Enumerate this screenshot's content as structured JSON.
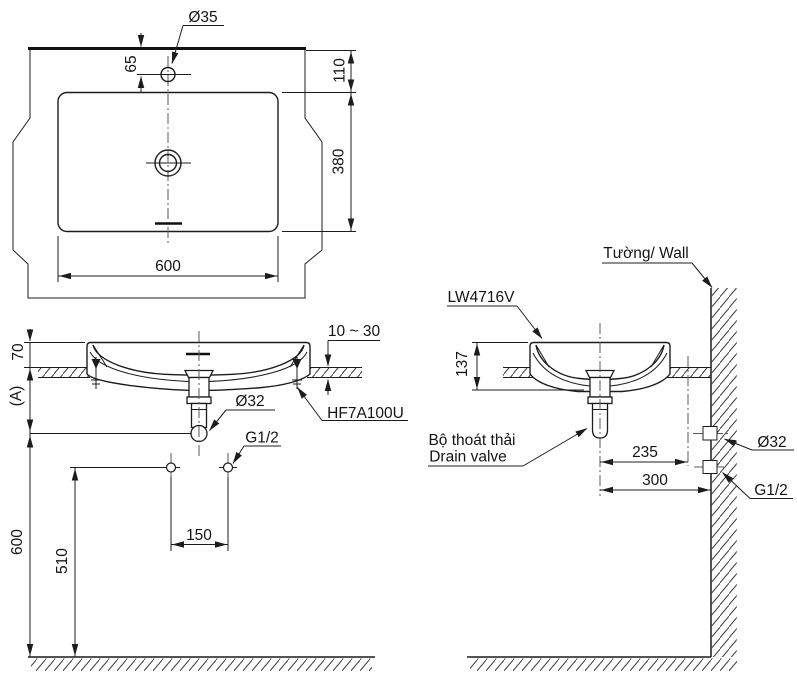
{
  "drawing": {
    "product_code": "LW4716V",
    "line_color": "#1c1c1c",
    "top_view": {
      "faucet_hole_dia": "Ø35",
      "faucet_offset": "65",
      "rim_to_back_edge": "110",
      "basin_depth": "380",
      "basin_width": "600"
    },
    "front_view": {
      "rim_above_counter": "70",
      "reference_dim": "(A)",
      "drain_pipe_dia": "Ø32",
      "supply_thread": "G1/2",
      "counter_thickness": "10 ~ 30",
      "fixing_kit_code": "HF7A100U",
      "supply_spacing": "150",
      "drain_end_height": "600",
      "supply_height": "510"
    },
    "side_view": {
      "wall_label": "Tường/ Wall",
      "model_label": "LW4716V",
      "basin_height": "137",
      "drain_valve_label_vi": "Bộ thoát thải",
      "drain_valve_label_en": "Drain valve",
      "drain_to_faucet_line": "235",
      "drain_to_wall": "300",
      "wall_outlet_dia": "Ø32",
      "wall_supply_thread": "G1/2"
    }
  }
}
